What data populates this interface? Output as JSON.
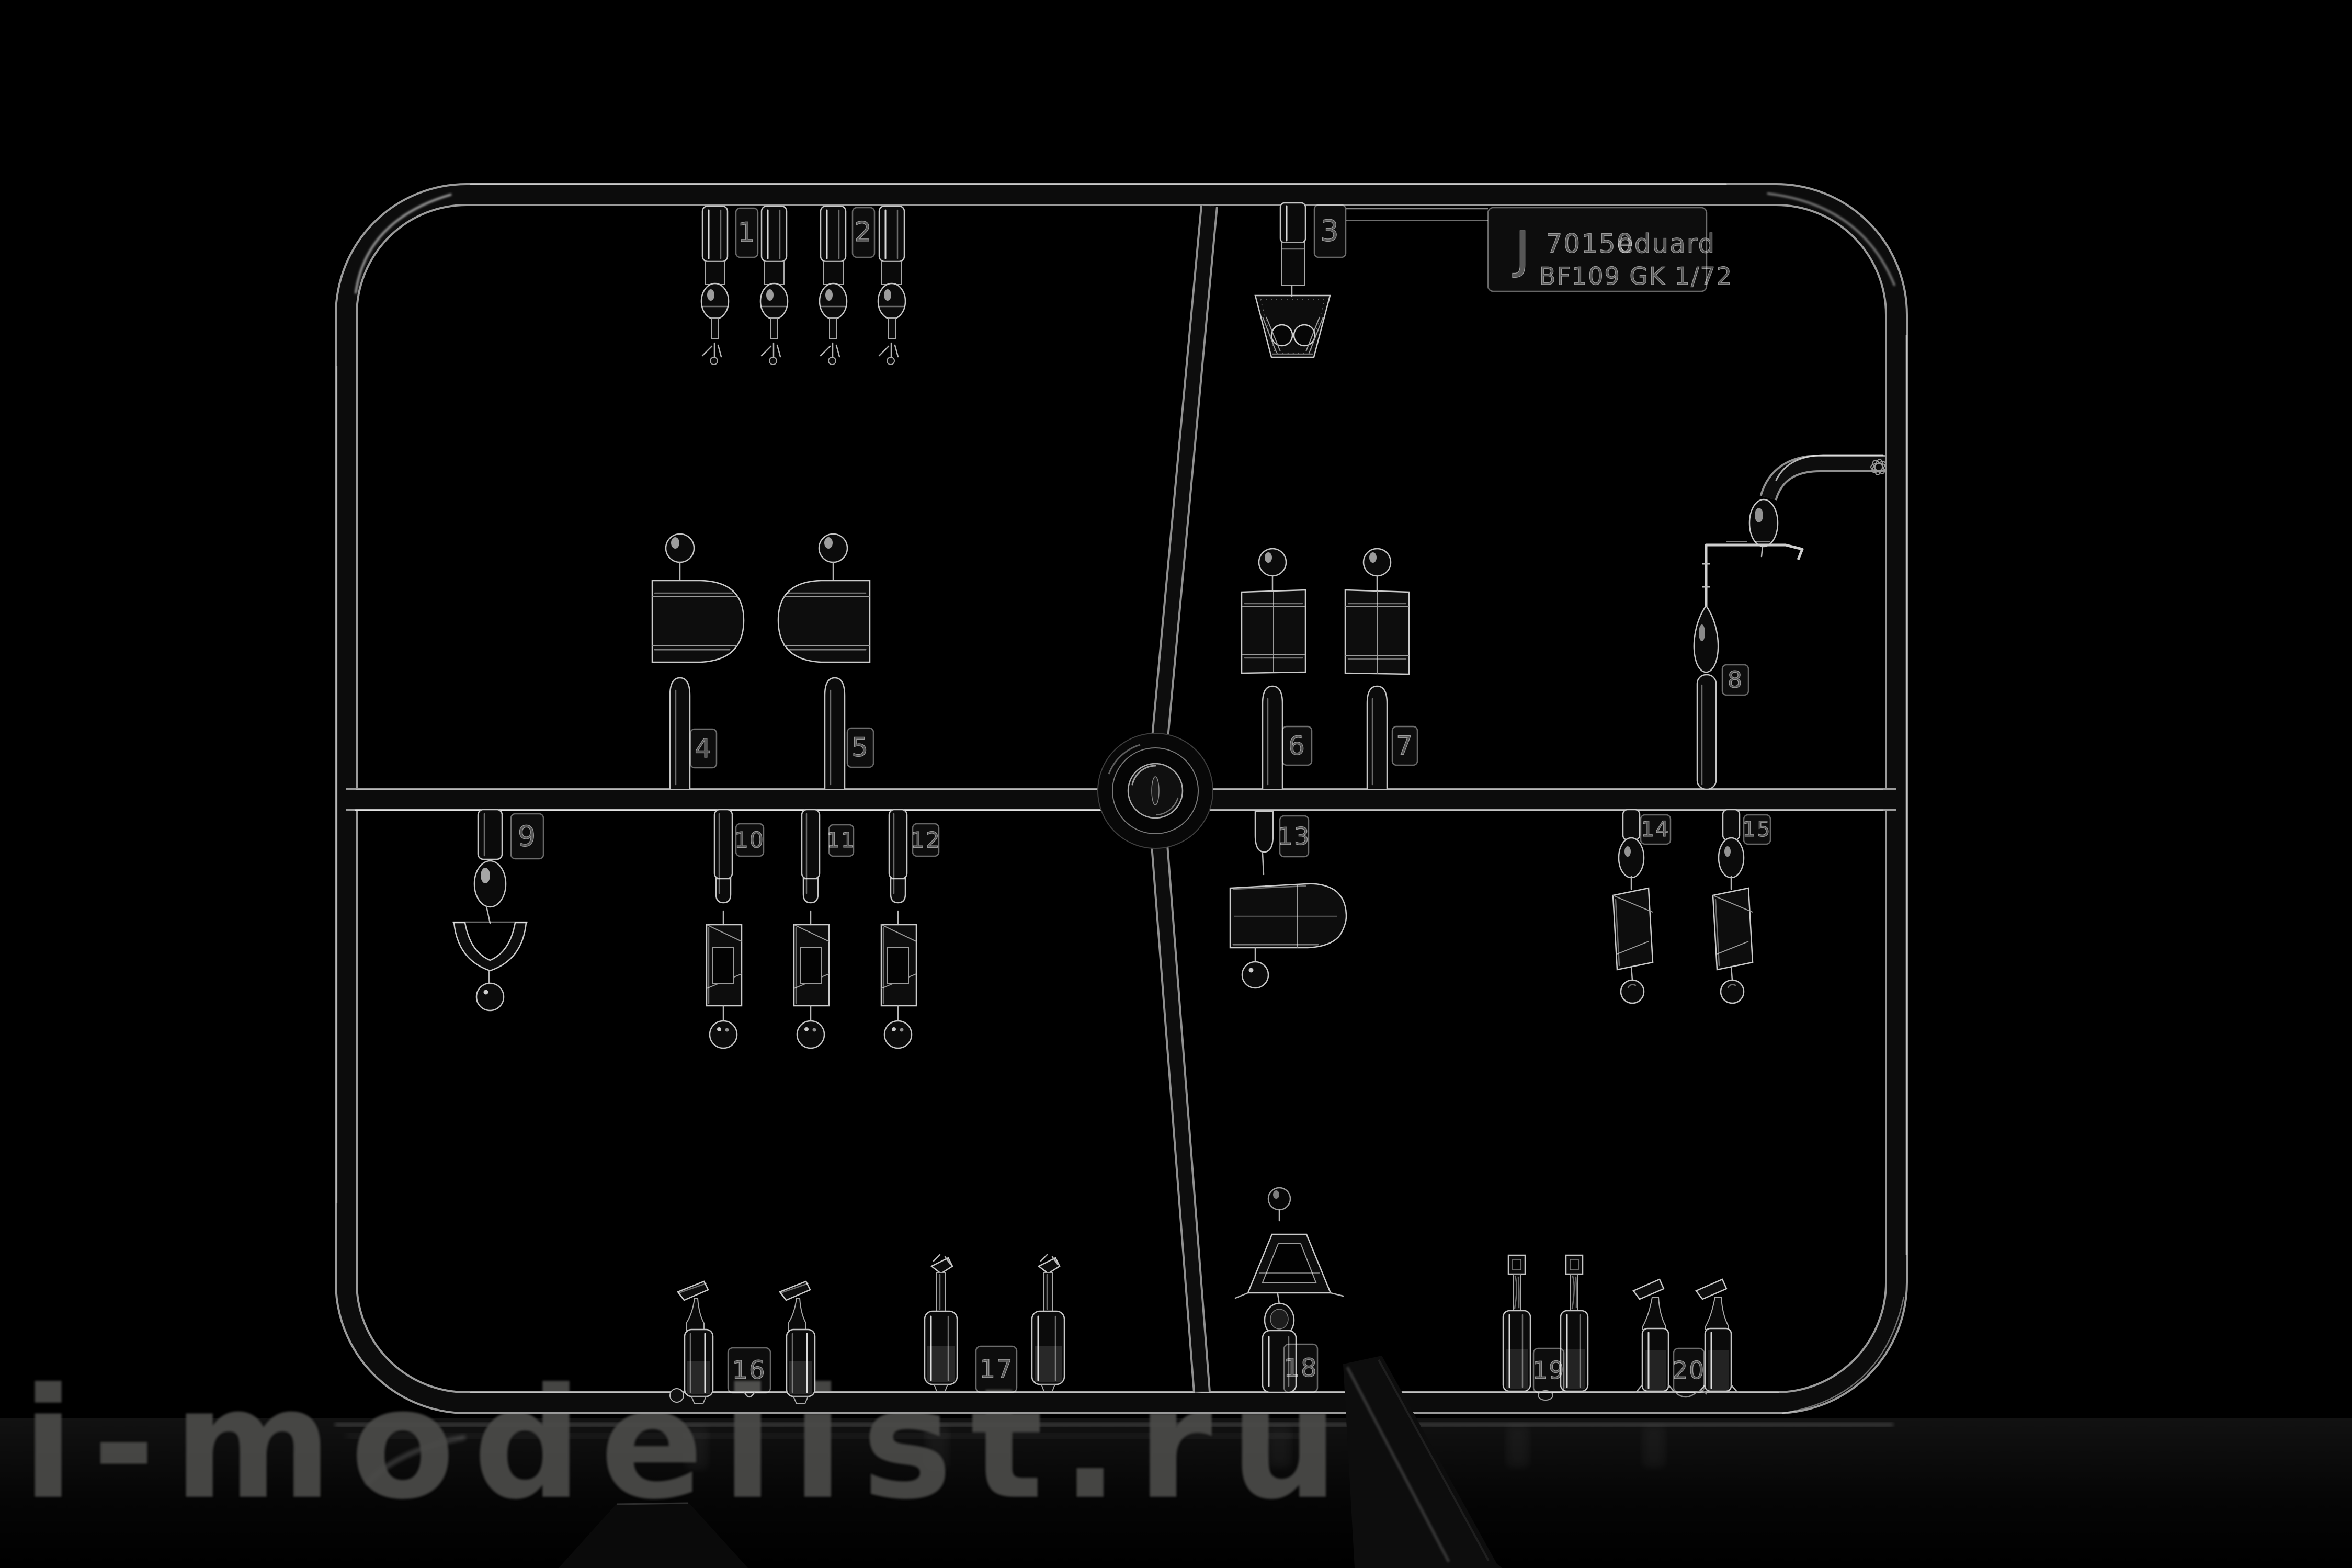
{
  "scene": {
    "background": "#000000",
    "plastic_edge_color": "#c6c6c6",
    "watermark_color": "#4b4b49"
  },
  "watermark": {
    "text": "i-modelist.ru"
  },
  "label_plate": {
    "letter": "J",
    "code": "70150",
    "brand": "eduard",
    "model_scale": "BF109 GK  1/72"
  },
  "part_tags": {
    "n1": "1",
    "n2": "2",
    "n3": "3",
    "n4": "4",
    "n5": "5",
    "n6": "6",
    "n7": "7",
    "n8": "8",
    "n9": "9",
    "n10": "10",
    "n11": "11",
    "n12": "12",
    "n13": "13",
    "n14": "14",
    "n15": "15",
    "n16": "16",
    "n17": "17",
    "n18": "18",
    "n19": "19",
    "n20": "20"
  }
}
